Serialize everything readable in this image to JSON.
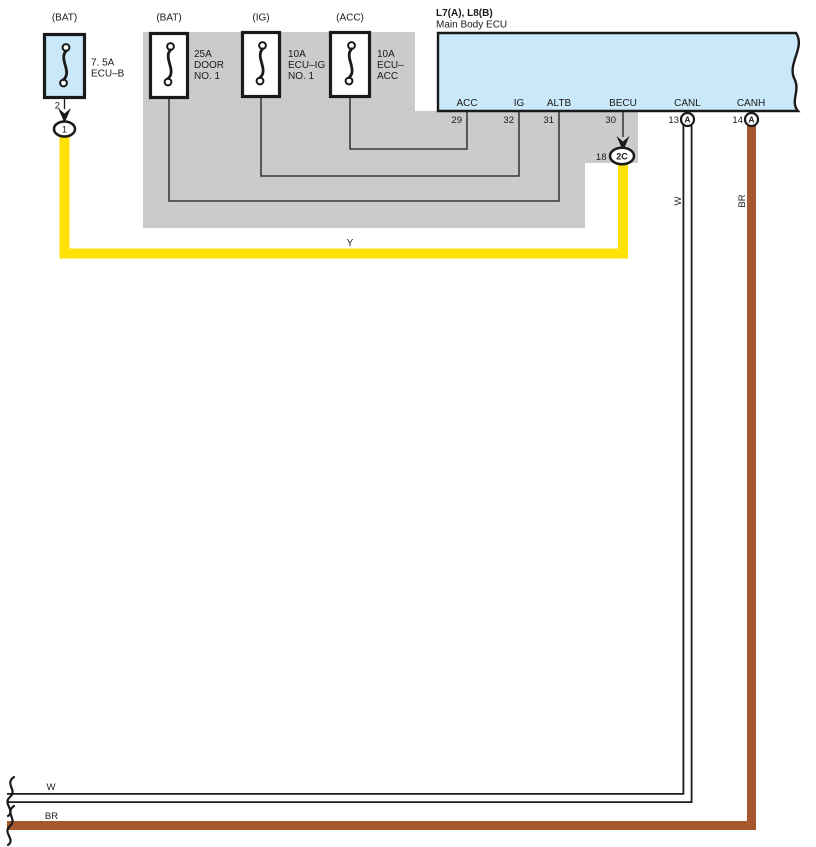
{
  "colors": {
    "panel_blue": "#c9e8f9",
    "bus_gray": "#cbcbcb",
    "wire_yellow": "#ffe103",
    "wire_brown": "#a6572e",
    "wire_white": "#ffffff",
    "line_black": "#1a1a1a"
  },
  "fuses": [
    {
      "source": "(BAT)",
      "lines": [
        "7. 5A",
        "ECU–B"
      ]
    },
    {
      "source": "(BAT)",
      "lines": [
        "25A",
        "DOOR",
        "NO. 1"
      ]
    },
    {
      "source": "(IG)",
      "lines": [
        "10A",
        "ECU–IG",
        "NO. 1"
      ]
    },
    {
      "source": "(ACC)",
      "lines": [
        "10A",
        "ECU–",
        "ACC"
      ]
    }
  ],
  "ecu": {
    "ref": "L7(A), L8(B)",
    "name": "Main Body ECU",
    "pins": [
      {
        "label": "ACC",
        "number": "29"
      },
      {
        "label": "IG",
        "number": "32"
      },
      {
        "label": "ALTB",
        "number": "31"
      },
      {
        "label": "BECU",
        "number": "30"
      },
      {
        "label": "CANL",
        "number": "13",
        "connector": "A"
      },
      {
        "label": "CANH",
        "number": "14",
        "connector": "A"
      }
    ]
  },
  "junctions": {
    "j1": {
      "pin_number": "2",
      "label": "1"
    },
    "j2c": {
      "pin_number": "18",
      "label": "2C"
    }
  },
  "wire_labels": {
    "becu": "Y",
    "canl": "W",
    "canh": "BR",
    "canl_bottom": "W",
    "canh_bottom": "BR"
  }
}
